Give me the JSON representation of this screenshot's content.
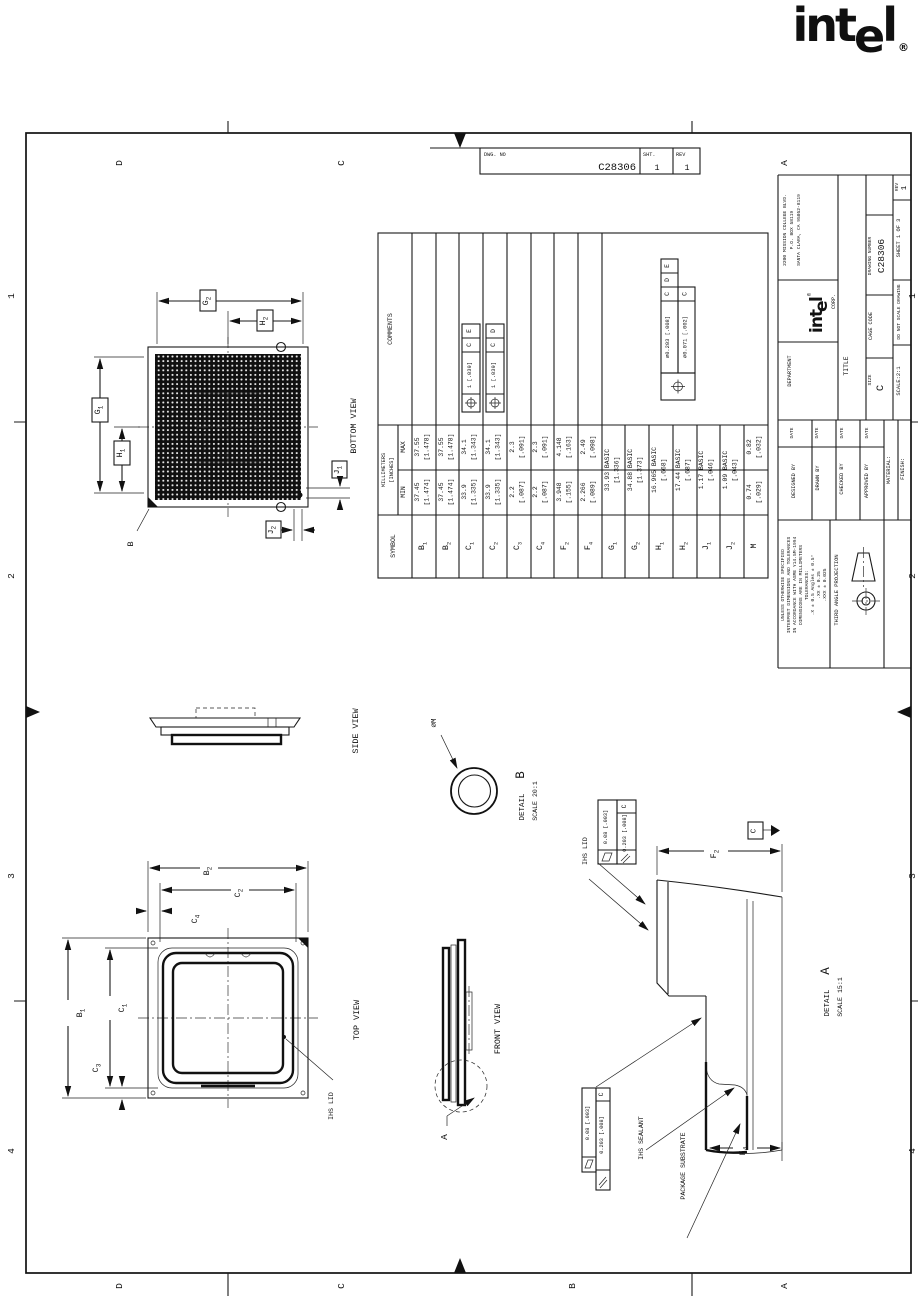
{
  "logo": {
    "p1": "int",
    "p2": "e",
    "p3": "l",
    "reg": "®"
  },
  "strip": {
    "dwg_no_label": "DWG. NO",
    "number": "C28306",
    "sht_label": "SHT.",
    "sht": "1",
    "rev_label": "REV",
    "rev": "1"
  },
  "zones": {
    "letters": [
      "D",
      "C",
      "B",
      "A"
    ],
    "numbers": [
      "1",
      "2",
      "3",
      "4"
    ]
  },
  "views": {
    "bottom": "BOTTOM VIEW",
    "top": "TOP VIEW",
    "side": "SIDE VIEW",
    "front": "FRONT VIEW"
  },
  "details": {
    "detail_word": "DETAIL",
    "a": "A",
    "a_scale": "SCALE 15:1",
    "b": "B",
    "b_scale": "SCALE 20:1"
  },
  "callouts": {
    "ihs_lid": "IHS LID",
    "ihs_sealant": "IHS SEALANT",
    "package_substrate": "PACKAGE SUBSTRATE",
    "dia_m": "∅M",
    "datum_b": "B",
    "datum_c": "C",
    "section_a": "A"
  },
  "fcf": {
    "flatness": "0.08 [.003]",
    "parallelism": "0.203 [.008]",
    "datum": "C"
  },
  "dims": {
    "g1": {
      "b": "G",
      "s": "1"
    },
    "g2": {
      "b": "G",
      "s": "2"
    },
    "h1": {
      "b": "H",
      "s": "1"
    },
    "h2": {
      "b": "H",
      "s": "2"
    },
    "j1": {
      "b": "J",
      "s": "1"
    },
    "j2": {
      "b": "J",
      "s": "2"
    },
    "b1": {
      "b": "B",
      "s": "1"
    },
    "b2": {
      "b": "B",
      "s": "2"
    },
    "c1": {
      "b": "C",
      "s": "1"
    },
    "c2": {
      "b": "C",
      "s": "2"
    },
    "c3": {
      "b": "C",
      "s": "3"
    },
    "c4": {
      "b": "C",
      "s": "4"
    },
    "f2": {
      "b": "F",
      "s": "2"
    },
    "f4": {
      "b": "F",
      "s": "4"
    }
  },
  "table": {
    "headers": {
      "symbol": "SYMBOL",
      "units_line1": "MILLIMETERS",
      "units_line2": "[INCHES]",
      "min": "MIN",
      "max": "MAX",
      "comments": "COMMENTS"
    },
    "rows": [
      {
        "sym": {
          "b": "B",
          "s": "1"
        },
        "min1": "37.45",
        "min2": "[1.474]",
        "max1": "37.55",
        "max2": "[1.478]"
      },
      {
        "sym": {
          "b": "B",
          "s": "2"
        },
        "min1": "37.45",
        "min2": "[1.474]",
        "max1": "37.55",
        "max2": "[1.478]"
      },
      {
        "sym": {
          "b": "C",
          "s": "1"
        },
        "min1": "33.9",
        "min2": "[1.335]",
        "max1": "34.1",
        "max2": "[1.343]",
        "tol": "1 [.039]",
        "d1": "C",
        "d2": "E"
      },
      {
        "sym": {
          "b": "C",
          "s": "2"
        },
        "min1": "33.9",
        "min2": "[1.335]",
        "max1": "34.1",
        "max2": "[1.343]",
        "tol": "1 [.039]",
        "d1": "C",
        "d2": "D"
      },
      {
        "sym": {
          "b": "C",
          "s": "3"
        },
        "min1": "2.2",
        "min2": "[.087]",
        "max1": "2.3",
        "max2": "[.091]"
      },
      {
        "sym": {
          "b": "C",
          "s": "4"
        },
        "min1": "2.2",
        "min2": "[.087]",
        "max1": "2.3",
        "max2": "[.091]"
      },
      {
        "sym": {
          "b": "F",
          "s": "2"
        },
        "min1": "3.948",
        "min2": "[.155]",
        "max1": "4.148",
        "max2": "[.163]"
      },
      {
        "sym": {
          "b": "F",
          "s": "4"
        },
        "min1": "2.266",
        "min2": "[.089]",
        "max1": "2.49",
        "max2": "[.098]"
      },
      {
        "sym": {
          "b": "G",
          "s": "1"
        },
        "basic1": "33.93 BASIC",
        "basic2": "[1.336]"
      },
      {
        "sym": {
          "b": "G",
          "s": "2"
        },
        "basic1": "34.88 BASIC",
        "basic2": "[1.373]"
      },
      {
        "sym": {
          "b": "H",
          "s": "1"
        },
        "basic1": "16.965 BASIC",
        "basic2": "[.668]"
      },
      {
        "sym": {
          "b": "H",
          "s": "2"
        },
        "basic1": "17.44 BASIC",
        "basic2": "[.687]"
      },
      {
        "sym": {
          "b": "J",
          "s": "1"
        },
        "basic1": "1.17 BASIC",
        "basic2": "[.046]"
      },
      {
        "sym": {
          "b": "J",
          "s": "2"
        },
        "basic1": "1.09 BASIC",
        "basic2": "[.043]"
      },
      {
        "sym": {
          "b": "M",
          "s": ""
        },
        "min1": "0.74",
        "min2": "[.029]",
        "max1": "0.82",
        "max2": "[.032]"
      }
    ],
    "composite": {
      "r1": "∅0.203 [.008]",
      "r1d1": "C",
      "r1d2": "D",
      "r1d3": "E",
      "r2": "∅0.071 [.002]",
      "r2d1": "C"
    }
  },
  "title_block": {
    "department": "DEPARTMENT",
    "corp": "CORP.",
    "address1": "2200 MISSION COLLEGE BLVD.",
    "address2": "P.O. BOX 58119",
    "address3": "SANTA CLARA, CA 95052-8119",
    "title_label": "TITLE",
    "size_label": "SIZE",
    "size": "C",
    "cage_label": "CAGE CODE",
    "dn_label": "DRAWING NUMBER",
    "dn": "C28306",
    "rev_label": "REV",
    "rev": "1",
    "scale": "SCALE:2:1",
    "dns": "DO NOT SCALE DRAWING",
    "sheet": "SHEET 1 OF 3",
    "designed": "DESIGNED BY",
    "drawn": "DRAWN BY",
    "checked": "CHECKED BY",
    "approved": "APPROVED BY",
    "date": "DATE",
    "material": "MATERIAL:",
    "finish": "FINISH:"
  },
  "tolerances": {
    "l1": "UNLESS OTHERWISE SPECIFIED",
    "l2": "INTERPRET DIMENSIONS AND TOLERANCES",
    "l3": "IN ACCORDANCE WITH ASME Y14.5M-1994",
    "l4": "DIMENSIONS ARE IN MILLIMETERS",
    "l5": "TOLERANCES:",
    "l6": ".X ± 0.5   Angles ± 0.5°",
    "l7": ".XX ± 0.25",
    "l8": ".XXX ± 0.025"
  },
  "projection": "THIRD ANGLE PROJECTION"
}
